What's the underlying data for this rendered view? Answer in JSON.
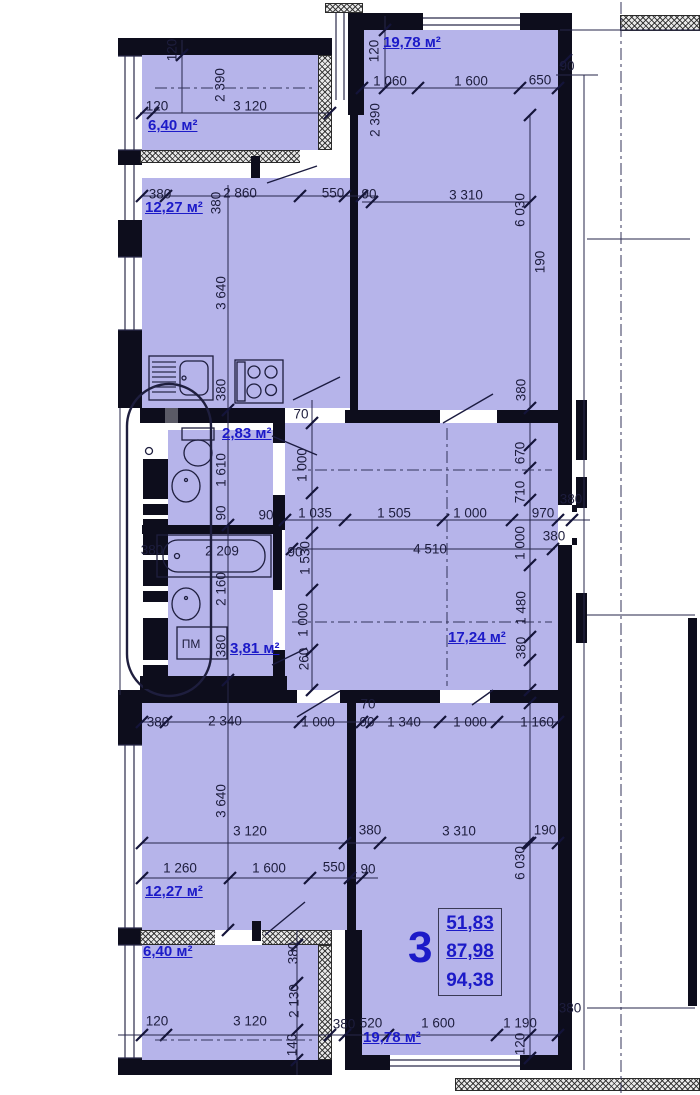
{
  "summary": {
    "rooms_count": "3",
    "line1": "51,83",
    "line2": "87,98",
    "line3": "94,38"
  },
  "labels": {
    "area": [
      {
        "name": "loggia-top",
        "t": "6,40 м²",
        "x": 148,
        "y": 118
      },
      {
        "name": "kitchen",
        "t": "12,27 м²",
        "x": 145,
        "y": 200
      },
      {
        "name": "bedroom-top",
        "t": "19,78 м²",
        "x": 383,
        "y": 35
      },
      {
        "name": "wc",
        "t": "2,83 м²",
        "x": 222,
        "y": 426
      },
      {
        "name": "bathroom",
        "t": "3,81 м²",
        "x": 230,
        "y": 641
      },
      {
        "name": "hall",
        "t": "17,24 м²",
        "x": 448,
        "y": 630
      },
      {
        "name": "room-bottom-left",
        "t": "12,27 м²",
        "x": 145,
        "y": 884
      },
      {
        "name": "room-bottom-right",
        "t": "19,78 м²",
        "x": 363,
        "y": 1030
      },
      {
        "name": "loggia-bottom",
        "t": "6,40 м²",
        "x": 143,
        "y": 944
      }
    ],
    "appliance": [
      {
        "name": "washing-machine",
        "t": "ПМ",
        "x": 191,
        "y": 644
      }
    ],
    "dims": [
      {
        "t": "120",
        "x": 172,
        "y": 50,
        "r": 1
      },
      {
        "t": "2 390",
        "x": 220,
        "y": 85,
        "r": 1
      },
      {
        "t": "120",
        "x": 157,
        "y": 106,
        "r": 0
      },
      {
        "t": "3 120",
        "x": 250,
        "y": 106,
        "r": 0
      },
      {
        "t": "120",
        "x": 374,
        "y": 51,
        "r": 1
      },
      {
        "t": "1 060",
        "x": 390,
        "y": 81,
        "r": 0
      },
      {
        "t": "1 600",
        "x": 471,
        "y": 81,
        "r": 0
      },
      {
        "t": "650",
        "x": 540,
        "y": 80,
        "r": 0
      },
      {
        "t": "90",
        "x": 567,
        "y": 66,
        "r": 0
      },
      {
        "t": "2 390",
        "x": 375,
        "y": 120,
        "r": 1
      },
      {
        "t": "90",
        "x": 369,
        "y": 194,
        "r": 0
      },
      {
        "t": "3 310",
        "x": 466,
        "y": 195,
        "r": 0
      },
      {
        "t": "6 030",
        "x": 520,
        "y": 210,
        "r": 1
      },
      {
        "t": "190",
        "x": 540,
        "y": 262,
        "r": 1
      },
      {
        "t": "380",
        "x": 521,
        "y": 390,
        "r": 1
      },
      {
        "t": "380",
        "x": 160,
        "y": 194,
        "r": 0
      },
      {
        "t": "2 860",
        "x": 240,
        "y": 193,
        "r": 0
      },
      {
        "t": "380",
        "x": 216,
        "y": 203,
        "r": 1
      },
      {
        "t": "550",
        "x": 333,
        "y": 193,
        "r": 0
      },
      {
        "t": "3 640",
        "x": 221,
        "y": 293,
        "r": 1
      },
      {
        "t": "380",
        "x": 221,
        "y": 390,
        "r": 1
      },
      {
        "t": "1 610",
        "x": 221,
        "y": 470,
        "r": 1
      },
      {
        "t": "90",
        "x": 221,
        "y": 513,
        "r": 1
      },
      {
        "t": "2 209",
        "x": 222,
        "y": 551,
        "r": 0
      },
      {
        "t": "2 160",
        "x": 221,
        "y": 589,
        "r": 1
      },
      {
        "t": "380",
        "x": 152,
        "y": 550,
        "r": 0
      },
      {
        "t": "380",
        "x": 221,
        "y": 646,
        "r": 1
      },
      {
        "t": "70",
        "x": 301,
        "y": 414,
        "r": 0
      },
      {
        "t": "1 000",
        "x": 302,
        "y": 465,
        "r": 1
      },
      {
        "t": "90",
        "x": 266,
        "y": 515,
        "r": 0
      },
      {
        "t": "1 035",
        "x": 315,
        "y": 513,
        "r": 0
      },
      {
        "t": "90",
        "x": 295,
        "y": 552,
        "r": 0
      },
      {
        "t": "1 530",
        "x": 305,
        "y": 558,
        "r": 1
      },
      {
        "t": "1 000",
        "x": 303,
        "y": 620,
        "r": 1
      },
      {
        "t": "260",
        "x": 304,
        "y": 659,
        "r": 1
      },
      {
        "t": "1 505",
        "x": 394,
        "y": 513,
        "r": 0
      },
      {
        "t": "1 000",
        "x": 470,
        "y": 513,
        "r": 0
      },
      {
        "t": "970",
        "x": 543,
        "y": 513,
        "r": 0
      },
      {
        "t": "4 510",
        "x": 430,
        "y": 549,
        "r": 0
      },
      {
        "t": "670",
        "x": 520,
        "y": 453,
        "r": 1
      },
      {
        "t": "710",
        "x": 520,
        "y": 492,
        "r": 1
      },
      {
        "t": "1 000",
        "x": 520,
        "y": 543,
        "r": 1
      },
      {
        "t": "1 480",
        "x": 521,
        "y": 608,
        "r": 1
      },
      {
        "t": "380",
        "x": 521,
        "y": 648,
        "r": 1
      },
      {
        "t": "380",
        "x": 571,
        "y": 499,
        "r": 0
      },
      {
        "t": "380",
        "x": 554,
        "y": 536,
        "r": 0
      },
      {
        "t": "380",
        "x": 158,
        "y": 722,
        "r": 0
      },
      {
        "t": "2 340",
        "x": 225,
        "y": 721,
        "r": 0
      },
      {
        "t": "1 000",
        "x": 318,
        "y": 722,
        "r": 0
      },
      {
        "t": "70",
        "x": 368,
        "y": 704,
        "r": 0
      },
      {
        "t": "90",
        "x": 367,
        "y": 722,
        "r": 0
      },
      {
        "t": "1 340",
        "x": 404,
        "y": 722,
        "r": 0
      },
      {
        "t": "1 000",
        "x": 470,
        "y": 722,
        "r": 0
      },
      {
        "t": "1 160",
        "x": 537,
        "y": 722,
        "r": 0
      },
      {
        "t": "3 640",
        "x": 221,
        "y": 801,
        "r": 1
      },
      {
        "t": "3 120",
        "x": 250,
        "y": 831,
        "r": 0
      },
      {
        "t": "380",
        "x": 370,
        "y": 830,
        "r": 0
      },
      {
        "t": "3 310",
        "x": 459,
        "y": 831,
        "r": 0
      },
      {
        "t": "190",
        "x": 545,
        "y": 830,
        "r": 0
      },
      {
        "t": "6 030",
        "x": 520,
        "y": 863,
        "r": 1
      },
      {
        "t": "1 260",
        "x": 180,
        "y": 868,
        "r": 0
      },
      {
        "t": "1 600",
        "x": 269,
        "y": 868,
        "r": 0
      },
      {
        "t": "550",
        "x": 334,
        "y": 867,
        "r": 0
      },
      {
        "t": "90",
        "x": 368,
        "y": 869,
        "r": 0
      },
      {
        "t": "380",
        "x": 293,
        "y": 953,
        "r": 1
      },
      {
        "t": "2 130",
        "x": 294,
        "y": 1001,
        "r": 1
      },
      {
        "t": "140",
        "x": 292,
        "y": 1045,
        "r": 1
      },
      {
        "t": "120",
        "x": 157,
        "y": 1021,
        "r": 0
      },
      {
        "t": "3 120",
        "x": 250,
        "y": 1021,
        "r": 0
      },
      {
        "t": "380",
        "x": 344,
        "y": 1024,
        "r": 0
      },
      {
        "t": "520",
        "x": 371,
        "y": 1023,
        "r": 0
      },
      {
        "t": "1 600",
        "x": 438,
        "y": 1023,
        "r": 0
      },
      {
        "t": "1 190",
        "x": 520,
        "y": 1023,
        "r": 0
      },
      {
        "t": "120",
        "x": 520,
        "y": 1044,
        "r": 1
      },
      {
        "t": "380",
        "x": 570,
        "y": 1008,
        "r": 0
      }
    ]
  },
  "colors": {
    "room_fill": "#b6b4ea",
    "wall": "#0d0d1c",
    "dim_text": "#1d1d3d",
    "accent_blue": "#1c1ac8"
  }
}
